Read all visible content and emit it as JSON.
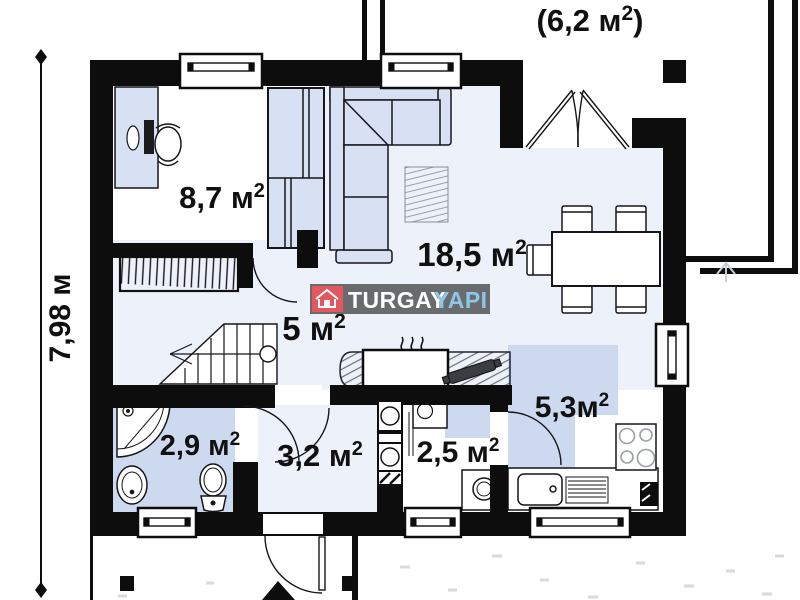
{
  "plan": {
    "upper_floor_note": {
      "open": "(6,2 м",
      "sup": "2",
      "close": ")"
    },
    "dimension_left": "7,98 м",
    "rooms": {
      "bedroom": {
        "value": "8,7 м",
        "sup": "2"
      },
      "living": {
        "value": "18,5 м",
        "sup": "2"
      },
      "hall": {
        "value": "5 м",
        "sup": "2"
      },
      "bathroom": {
        "value": "2,9 м",
        "sup": "2"
      },
      "entry": {
        "value": "3,2 м",
        "sup": "2"
      },
      "utility": {
        "value": "2,5 м",
        "sup": "2"
      },
      "kitchen": {
        "value": "5,3м",
        "sup": "2"
      }
    },
    "logo": {
      "brand": "TURGAY",
      "brand2": "YAPI"
    },
    "colors": {
      "wall": "#0d0d0d",
      "floor_tint": "#edf2fa",
      "floor_blue": "#cdd9ee",
      "furniture_blue": "#d7e1f3",
      "logo_bg": "#6a6b6d",
      "logo_red": "#e25760",
      "logo_blue": "#8dc6e8"
    }
  }
}
